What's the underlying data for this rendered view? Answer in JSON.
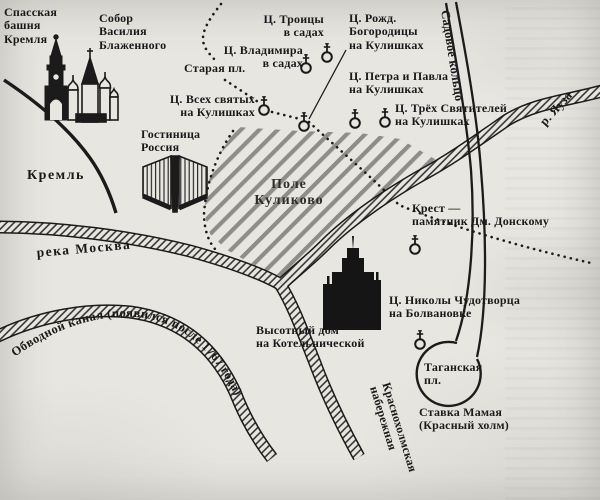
{
  "figure": {
    "paper_color": "#e8e6e1",
    "ink_color": "#1b1b1b",
    "field_hatch_color": "#8f8d89",
    "labels": {
      "spasskaya": "Спасская\nбашня\nКремля",
      "st_basil": "Собор\nВасилия\nБлаженного",
      "troitsy": "Ц. Троицы\nв садах",
      "vladimira": "Ц. Владимира\nв садах",
      "staraya": "Старая пл.",
      "rozhd": "Ц. Рожд.\nБогородицы\nна Кулишках",
      "vsekh": "Ц. Всех святых\nна Кулишках",
      "petra": "Ц. Петра и Павла\nна Кулишках",
      "tryokh": "Ц. Трёх Святителей\nна Кулишках",
      "sadovoe": "Садовое кольцо",
      "yauza": "р. Яуза",
      "kreml": "Кремль",
      "gostinitsa": "Гостиница\nРоссия",
      "pole": "Поле\nКуликово",
      "krest": "Крест —\nпамятник Дм. Донскому",
      "reka_moskva": "река Москва",
      "obvodnoy": "Обводной канал (появился после 1767 года)",
      "vysotny": "Высотный дом\nна Котельнической",
      "nikoly": "Ц. Николы Чудотворца\nна Болвановке",
      "taganskaya": "Таганская\nпл.",
      "stavka": "Ставка Мамая\n(Красный холм)",
      "krasnokholm": "Краснохолмская\nнабережная"
    },
    "icons": {
      "church_marker": "circle-with-orthodox-cross",
      "count_church_markers": 8
    }
  }
}
